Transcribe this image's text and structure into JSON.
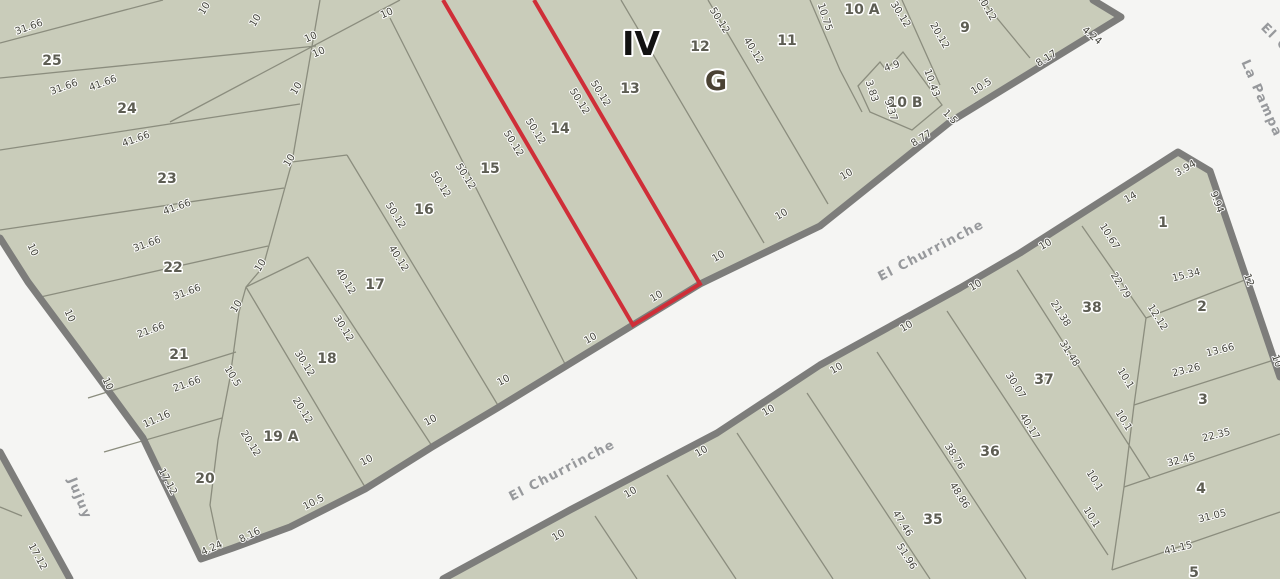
{
  "map": {
    "highlighted_parcel": "14",
    "colors": {
      "street_background": "#f5f5f3",
      "block_fill": "#c9ccba",
      "street_border": "#7d7d7b",
      "parcel_line": "#8b8d7e",
      "selection_red": "#cf2e38"
    },
    "block_labels": [
      {
        "text": "IV",
        "x": 641,
        "y": 55,
        "kind": "roman"
      },
      {
        "text": "G",
        "x": 716,
        "y": 90,
        "kind": "gletter"
      }
    ],
    "street_names": [
      {
        "text": "El Churrinche",
        "x": 933,
        "y": 254,
        "r": -27.5
      },
      {
        "text": "El Churrinche",
        "x": 564,
        "y": 474,
        "r": -27.5
      },
      {
        "text": "Jujuy",
        "x": 76,
        "y": 500,
        "r": 68
      },
      {
        "text": "La Pampa",
        "x": 1258,
        "y": 100,
        "r": 66
      },
      {
        "text": "El C",
        "x": 1272,
        "y": 40,
        "r": 45
      }
    ],
    "parcel_numbers": [
      {
        "text": "25",
        "x": 52,
        "y": 65
      },
      {
        "text": "24",
        "x": 127,
        "y": 113
      },
      {
        "text": "23",
        "x": 167,
        "y": 183
      },
      {
        "text": "22",
        "x": 173,
        "y": 272
      },
      {
        "text": "21",
        "x": 179,
        "y": 359
      },
      {
        "text": "20",
        "x": 205,
        "y": 483
      },
      {
        "text": "19 A",
        "x": 281,
        "y": 441
      },
      {
        "text": "18",
        "x": 327,
        "y": 363
      },
      {
        "text": "17",
        "x": 375,
        "y": 289
      },
      {
        "text": "16",
        "x": 424,
        "y": 214
      },
      {
        "text": "15",
        "x": 490,
        "y": 173
      },
      {
        "text": "14",
        "x": 560,
        "y": 133
      },
      {
        "text": "13",
        "x": 630,
        "y": 93
      },
      {
        "text": "12",
        "x": 700,
        "y": 51
      },
      {
        "text": "11",
        "x": 787,
        "y": 45
      },
      {
        "text": "10 A",
        "x": 862,
        "y": 14
      },
      {
        "text": "10 B",
        "x": 905,
        "y": 107
      },
      {
        "text": "9",
        "x": 965,
        "y": 32
      },
      {
        "text": "1",
        "x": 1163,
        "y": 227
      },
      {
        "text": "2",
        "x": 1202,
        "y": 311
      },
      {
        "text": "3",
        "x": 1203,
        "y": 404
      },
      {
        "text": "4",
        "x": 1201,
        "y": 493
      },
      {
        "text": "5",
        "x": 1194,
        "y": 577
      },
      {
        "text": "38",
        "x": 1092,
        "y": 312
      },
      {
        "text": "37",
        "x": 1044,
        "y": 384
      },
      {
        "text": "36",
        "x": 990,
        "y": 456
      },
      {
        "text": "35",
        "x": 933,
        "y": 524
      }
    ],
    "dimensions": [
      {
        "text": "31.66",
        "x": 30,
        "y": 30,
        "r": -20
      },
      {
        "text": "31.66",
        "x": 65,
        "y": 90,
        "r": -20
      },
      {
        "text": "41.66",
        "x": 104,
        "y": 86,
        "r": -20
      },
      {
        "text": "41.66",
        "x": 137,
        "y": 142,
        "r": -20
      },
      {
        "text": "41.66",
        "x": 178,
        "y": 210,
        "r": -20
      },
      {
        "text": "31.66",
        "x": 148,
        "y": 247,
        "r": -20
      },
      {
        "text": "31.66",
        "x": 188,
        "y": 295,
        "r": -20
      },
      {
        "text": "21.66",
        "x": 152,
        "y": 333,
        "r": -20
      },
      {
        "text": "21.66",
        "x": 188,
        "y": 387,
        "r": -20
      },
      {
        "text": "11.16",
        "x": 158,
        "y": 422,
        "r": -24
      },
      {
        "text": "17.12",
        "x": 165,
        "y": 483,
        "r": 62
      },
      {
        "text": "17.12",
        "x": 35,
        "y": 558,
        "r": 62
      },
      {
        "text": "10",
        "x": 30,
        "y": 251,
        "r": 65
      },
      {
        "text": "10",
        "x": 67,
        "y": 317,
        "r": 65
      },
      {
        "text": "10",
        "x": 105,
        "y": 385,
        "r": 65
      },
      {
        "text": "10",
        "x": 207,
        "y": 10,
        "r": -58
      },
      {
        "text": "10",
        "x": 258,
        "y": 22,
        "r": -58
      },
      {
        "text": "10",
        "x": 312,
        "y": 40,
        "r": -24
      },
      {
        "text": "10",
        "x": 320,
        "y": 55,
        "r": -24
      },
      {
        "text": "10",
        "x": 388,
        "y": 16,
        "r": -24
      },
      {
        "text": "10",
        "x": 299,
        "y": 90,
        "r": -58
      },
      {
        "text": "10",
        "x": 292,
        "y": 162,
        "r": -58
      },
      {
        "text": "10",
        "x": 263,
        "y": 267,
        "r": -58
      },
      {
        "text": "10",
        "x": 239,
        "y": 308,
        "r": -58
      },
      {
        "text": "10.5",
        "x": 230,
        "y": 378,
        "r": 58
      },
      {
        "text": "30.12",
        "x": 302,
        "y": 365,
        "r": 58
      },
      {
        "text": "20.12",
        "x": 300,
        "y": 412,
        "r": 58
      },
      {
        "text": "20.12",
        "x": 248,
        "y": 445,
        "r": 58
      },
      {
        "text": "4.24",
        "x": 213,
        "y": 551,
        "r": -24
      },
      {
        "text": "8.16",
        "x": 251,
        "y": 538,
        "r": -26
      },
      {
        "text": "10.5",
        "x": 315,
        "y": 505,
        "r": -27
      },
      {
        "text": "10",
        "x": 368,
        "y": 463,
        "r": -28
      },
      {
        "text": "10",
        "x": 432,
        "y": 423,
        "r": -29
      },
      {
        "text": "10",
        "x": 505,
        "y": 383,
        "r": -29
      },
      {
        "text": "10",
        "x": 592,
        "y": 341,
        "r": -30
      },
      {
        "text": "10",
        "x": 658,
        "y": 299,
        "r": -31
      },
      {
        "text": "10",
        "x": 720,
        "y": 259,
        "r": -31
      },
      {
        "text": "10",
        "x": 783,
        "y": 217,
        "r": -31
      },
      {
        "text": "10",
        "x": 848,
        "y": 177,
        "r": -31
      },
      {
        "text": "30.12",
        "x": 341,
        "y": 330,
        "r": 58
      },
      {
        "text": "40.12",
        "x": 343,
        "y": 283,
        "r": 58
      },
      {
        "text": "40.12",
        "x": 396,
        "y": 260,
        "r": 58
      },
      {
        "text": "50.12",
        "x": 393,
        "y": 217,
        "r": 58
      },
      {
        "text": "50.12",
        "x": 438,
        "y": 186,
        "r": 58
      },
      {
        "text": "50.12",
        "x": 463,
        "y": 178,
        "r": 58
      },
      {
        "text": "50.12",
        "x": 511,
        "y": 145,
        "r": 58
      },
      {
        "text": "50.12",
        "x": 533,
        "y": 133,
        "r": 58
      },
      {
        "text": "50.12",
        "x": 577,
        "y": 103,
        "r": 58
      },
      {
        "text": "50.12",
        "x": 598,
        "y": 95,
        "r": 58
      },
      {
        "text": "50.12",
        "x": 717,
        "y": 22,
        "r": 58
      },
      {
        "text": "40.12",
        "x": 751,
        "y": 52,
        "r": 58
      },
      {
        "text": "30.12",
        "x": 898,
        "y": 16,
        "r": 58
      },
      {
        "text": "10.75",
        "x": 822,
        "y": 18,
        "r": 72
      },
      {
        "text": "20.12",
        "x": 937,
        "y": 37,
        "r": 60
      },
      {
        "text": "10.12",
        "x": 984,
        "y": 9,
        "r": 60
      },
      {
        "text": "4.9",
        "x": 893,
        "y": 69,
        "r": -20
      },
      {
        "text": "3.83",
        "x": 869,
        "y": 92,
        "r": 72
      },
      {
        "text": "9.37",
        "x": 888,
        "y": 111,
        "r": 72
      },
      {
        "text": "10.43",
        "x": 929,
        "y": 84,
        "r": 70
      },
      {
        "text": "1.5",
        "x": 948,
        "y": 119,
        "r": 45
      },
      {
        "text": "8.77",
        "x": 923,
        "y": 141,
        "r": -32
      },
      {
        "text": "10.5",
        "x": 983,
        "y": 89,
        "r": -32
      },
      {
        "text": "8.17",
        "x": 1048,
        "y": 61,
        "r": -32
      },
      {
        "text": "4.24",
        "x": 1090,
        "y": 38,
        "r": 40
      },
      {
        "text": "3.94",
        "x": 1187,
        "y": 171,
        "r": -30
      },
      {
        "text": "14",
        "x": 1132,
        "y": 200,
        "r": -30
      },
      {
        "text": "9.94",
        "x": 1214,
        "y": 203,
        "r": 70
      },
      {
        "text": "12",
        "x": 1246,
        "y": 281,
        "r": 70
      },
      {
        "text": "10",
        "x": 1274,
        "y": 362,
        "r": 70
      },
      {
        "text": "15.34",
        "x": 1187,
        "y": 278,
        "r": -14
      },
      {
        "text": "12.12",
        "x": 1155,
        "y": 319,
        "r": 58
      },
      {
        "text": "13.66",
        "x": 1221,
        "y": 353,
        "r": -14
      },
      {
        "text": "23.26",
        "x": 1187,
        "y": 373,
        "r": -14
      },
      {
        "text": "22.35",
        "x": 1217,
        "y": 438,
        "r": -14
      },
      {
        "text": "32.45",
        "x": 1182,
        "y": 463,
        "r": -14
      },
      {
        "text": "31.05",
        "x": 1213,
        "y": 519,
        "r": -14
      },
      {
        "text": "41.15",
        "x": 1179,
        "y": 551,
        "r": -14
      },
      {
        "text": "10.1",
        "x": 1123,
        "y": 380,
        "r": 58
      },
      {
        "text": "10.1",
        "x": 1121,
        "y": 422,
        "r": 58
      },
      {
        "text": "10.1",
        "x": 1092,
        "y": 482,
        "r": 58
      },
      {
        "text": "10.1",
        "x": 1089,
        "y": 519,
        "r": 58
      },
      {
        "text": "10.67",
        "x": 1107,
        "y": 238,
        "r": 58
      },
      {
        "text": "22.79",
        "x": 1118,
        "y": 287,
        "r": 58
      },
      {
        "text": "21.38",
        "x": 1058,
        "y": 315,
        "r": 58
      },
      {
        "text": "31.48",
        "x": 1067,
        "y": 355,
        "r": 58
      },
      {
        "text": "30.07",
        "x": 1013,
        "y": 387,
        "r": 58
      },
      {
        "text": "40.17",
        "x": 1027,
        "y": 428,
        "r": 58
      },
      {
        "text": "38.76",
        "x": 952,
        "y": 458,
        "r": 58
      },
      {
        "text": "48.86",
        "x": 957,
        "y": 497,
        "r": 58
      },
      {
        "text": "47.46",
        "x": 900,
        "y": 525,
        "r": 58
      },
      {
        "text": "51.96",
        "x": 904,
        "y": 558,
        "r": 58
      },
      {
        "text": "10",
        "x": 560,
        "y": 538,
        "r": -31
      },
      {
        "text": "10",
        "x": 632,
        "y": 495,
        "r": -31
      },
      {
        "text": "10",
        "x": 703,
        "y": 454,
        "r": -31
      },
      {
        "text": "10",
        "x": 770,
        "y": 413,
        "r": -31
      },
      {
        "text": "10",
        "x": 838,
        "y": 371,
        "r": -31
      },
      {
        "text": "10",
        "x": 908,
        "y": 329,
        "r": -31
      },
      {
        "text": "10",
        "x": 977,
        "y": 288,
        "r": -31
      },
      {
        "text": "10",
        "x": 1047,
        "y": 247,
        "r": -31
      }
    ]
  }
}
